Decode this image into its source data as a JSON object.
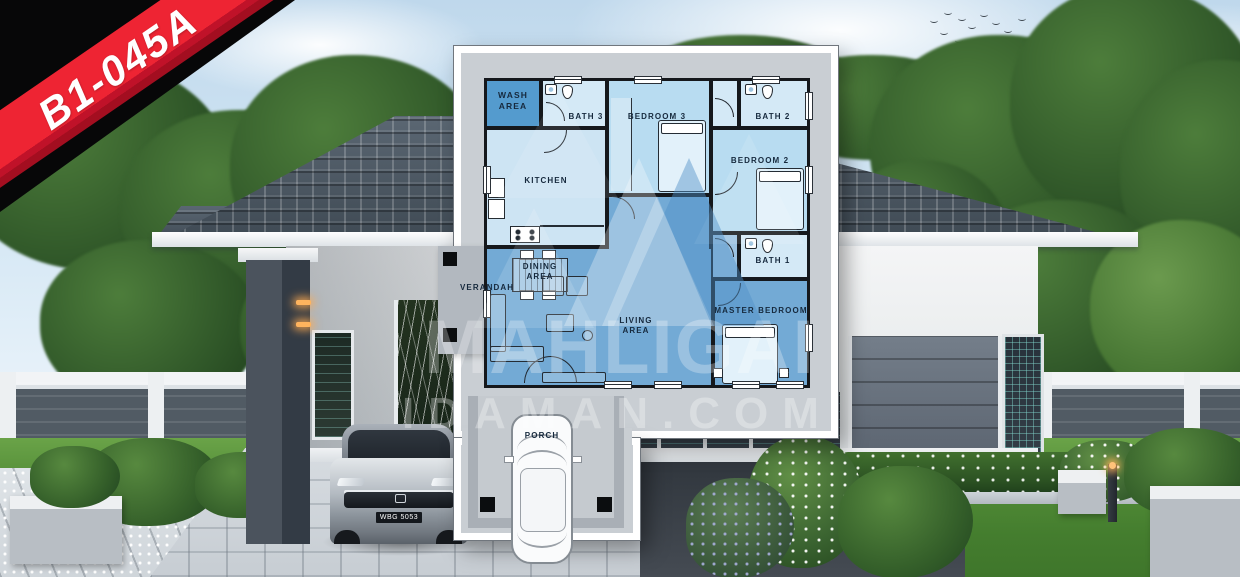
{
  "badge": {
    "code": "B1-045A",
    "ribbon_red": "#ee2433",
    "ribbon_dark": "#a30e20"
  },
  "watermark": {
    "line1": "MAHLIGAI",
    "line2": "IDAMAN.COM"
  },
  "scene": {
    "car_plate": "WBG 5053"
  },
  "floor_plan": {
    "colors": {
      "room_light": "#d4e9f6",
      "room_bedroom": "#b8dcf1",
      "room_mid": "#73aad5",
      "wash_area": "#549bce",
      "wall": "#15181c",
      "plan_band": "#c9ced3"
    },
    "rooms": [
      {
        "id": "wash-area",
        "label": "WASH AREA"
      },
      {
        "id": "bath-3",
        "label": "BATH 3"
      },
      {
        "id": "bedroom-3",
        "label": "BEDROOM 3"
      },
      {
        "id": "bath-2",
        "label": "BATH 2"
      },
      {
        "id": "bedroom-2",
        "label": "BEDROOM 2"
      },
      {
        "id": "kitchen",
        "label": "KITCHEN"
      },
      {
        "id": "bath-1",
        "label": "BATH 1"
      },
      {
        "id": "dining-area",
        "label": "DINING AREA"
      },
      {
        "id": "living-area",
        "label": "LIVING AREA"
      },
      {
        "id": "master-bedroom",
        "label": "MASTER BEDROOM"
      },
      {
        "id": "verandah",
        "label": "VERANDAH"
      },
      {
        "id": "porch",
        "label": "PORCH"
      }
    ]
  }
}
